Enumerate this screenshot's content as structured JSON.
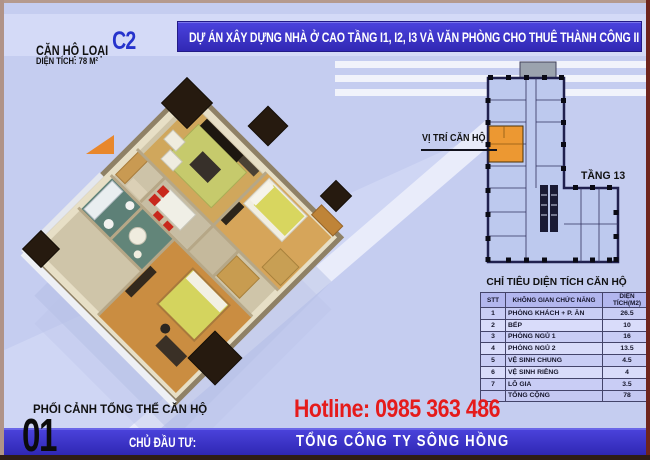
{
  "header": {
    "unit_type_label": "CĂN HỘ LOẠI",
    "unit_type_code": "C2",
    "unit_area": "DIỆN TÍCH: 78 M²",
    "project_banner": "DỰ ÁN XÂY DỰNG NHÀ Ở CAO TẦNG I1, I2, I3 VÀ VĂN PHÒNG CHO THUÊ THÀNH CÔNG II"
  },
  "plan_3d": {
    "caption": "PHỐI CẢNH TỔNG THỂ CĂN HỘ",
    "sheet_number": "01"
  },
  "location_panel": {
    "unit_location_label": "VỊ TRÍ CĂN HỘ",
    "floor_label": "TẦNG 13"
  },
  "area_table": {
    "title": "CHỈ TIÊU DIỆN TÍCH CĂN HỘ",
    "headers": [
      "STT",
      "KHÔNG GIAN CHỨC NĂNG",
      "DIỆN TÍCH(M2)"
    ],
    "rows": [
      {
        "stt": "1",
        "name": "PHÒNG KHÁCH + P. ĂN",
        "area": "26.5"
      },
      {
        "stt": "2",
        "name": "BẾP",
        "area": "10"
      },
      {
        "stt": "3",
        "name": "PHÒNG NGỦ 1",
        "area": "16"
      },
      {
        "stt": "4",
        "name": "PHÒNG NGỦ 2",
        "area": "13.5"
      },
      {
        "stt": "5",
        "name": "VỆ SINH CHUNG",
        "area": "4.5"
      },
      {
        "stt": "6",
        "name": "VỆ SINH RIÊNG",
        "area": "4"
      },
      {
        "stt": "7",
        "name": "LÔ GIA",
        "area": "3.5"
      },
      {
        "stt": "",
        "name": "TỔNG CỘNG",
        "area": "78"
      }
    ]
  },
  "footer": {
    "hotline": "Hotline: 0985 363 486",
    "developer_label": "CHỦ ĐẦU TƯ:",
    "developer_name": "TỔNG CÔNG TY SÔNG HỒNG"
  },
  "colors": {
    "banner_blue": "#3b34d0",
    "accent_blue": "#2633cc",
    "hotline_red": "#e51b1b",
    "footer_bar_blue": "#3a30c8",
    "unit_highlight_orange": "#ec9832",
    "floorplan_fill_blue": "#bdc9ee"
  }
}
